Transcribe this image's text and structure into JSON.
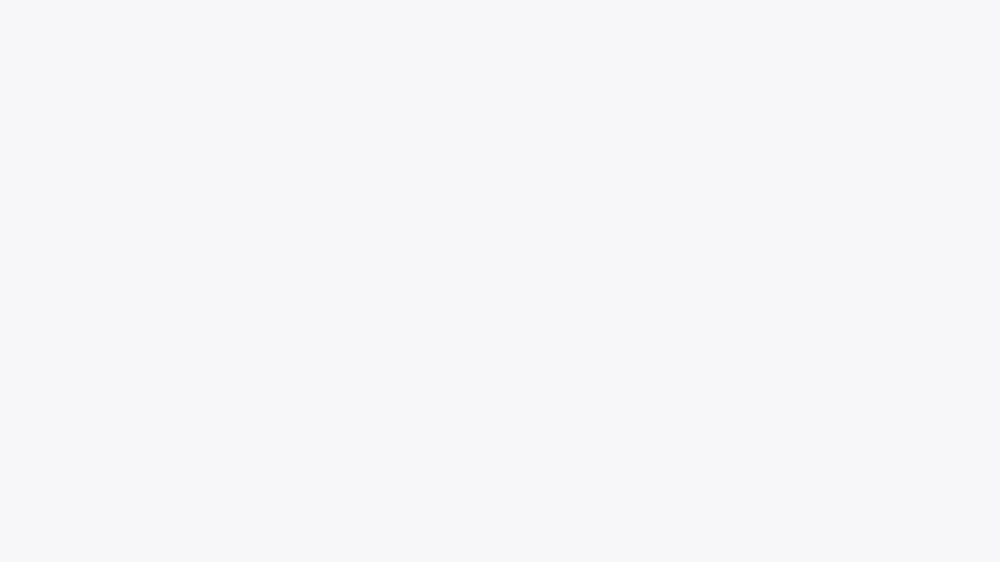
{
  "scene": {
    "description": "Isometric 3D cutaway render of a studio apartment with balcony",
    "style": "photorealistic isometric architectural visualization, no text or UI elements",
    "background": "#f7f7f9",
    "rooms": [
      "bathroom",
      "kitchen",
      "living-sleeping-area",
      "balcony"
    ]
  },
  "palette": {
    "background": "#f7f7f9",
    "shadow": "#d3d6e0",
    "slab_top": "#dde1e9",
    "slab_side": "#c9cfda",
    "floor_wood_light": "#e8caa0",
    "floor_wood_deep": "#cf9e6f",
    "plank_line": "rgba(150,100,55,0.30)",
    "deck_wood": "#cda077",
    "deck_line": "rgba(140,95,55,0.35)",
    "tile_light": "#ebe6dd",
    "wall_pink": "#f0ded6",
    "wall_white": "#f2f3f6",
    "wall_face_white": "#eef0f4",
    "wall_top": "#fafbfc",
    "wall_end": "#e8eaef",
    "wall_gray": "#c3c9d6",
    "wall_gray_light": "#dfe3eb",
    "bath_cream": "#f7e9d6",
    "bath_cream_deep": "#f1dcc1",
    "bath_floor": "#f6ecdc",
    "steel": "#aab1bd",
    "steel_light": "#cdd2db",
    "cabinet": "#efece6",
    "cabinet_line": "#d8d3c9",
    "cabinet_side": "#e2ded6",
    "counter_top": "#e8dcc8",
    "counter_speck": "#b2976f",
    "counter_face": "#bf9a64",
    "counter_face_dark": "#a4804c",
    "rattan": "#d8b386",
    "rattan_dark": "#c0965f",
    "appliance_black": "#16171a",
    "oven_white": "#f3f2f0",
    "oven_dark": "#26262a",
    "fridge_black": "#0d0e10",
    "fridge_col": "#f2f1ee",
    "fridge_col_side": "#e3e2df",
    "door_white": "#fbfbfc",
    "door_edge": "#d7dade",
    "handle_dark": "#4a4e55",
    "frame_gray": "#ccd1da",
    "wardrobe_side": "#dfe2e8",
    "wardrobe_top": "#f4f5f7",
    "shelf_wood": "#cfa163",
    "mirror_frame": "#c2996a",
    "mirror_glass": "#f0e4d4",
    "art_frame": "#c9a26b",
    "art_paper": "#faf7f2",
    "art_shape": "#d9c2a2",
    "art_shape2": "#cbb18e",
    "sconce_black": "#1d1e22",
    "headboard": "#cfa873",
    "headboard_dark": "#b08546",
    "bed_base": "#e9ebef",
    "bed_base_shade": "#d4d7de",
    "mattress": "#a7adb4",
    "mattress_dark": "#969ca3",
    "duvet": "#c6cbd1",
    "blanket": "#eceef1",
    "pillow_plaid": "#8b8272",
    "pillow_plaid2": "#7f776a",
    "pillow_gray": "#a8adb2",
    "nightstand": "#f0f1f4",
    "nightstand_side": "#dfe1e7",
    "stool": "#e8dfd3",
    "stool_shade": "#d5cabb",
    "sofa": "#ddd7c7",
    "sofa_shade": "#cbc4b2",
    "sofa_rattan": "#c9a06a",
    "table_wood": "#c69557",
    "table_wood_dark": "#a87a40",
    "side_table": "#e5dcd2",
    "pot_white": "#eff0f2",
    "pot_gray": "#c2c8d2",
    "green": "#41793a",
    "green_dark": "#2f5c2a",
    "green_light": "#5e9a4b",
    "green_bright": "#6fae57",
    "planter_white": "#edeef0",
    "planter_side": "#dcdfe4",
    "planter_cap": "#565b62",
    "pillar": "#f0ede5",
    "pillar_side": "#e2ded3",
    "glass": "rgba(196,210,222,0.30)",
    "glass_edge": "rgba(120,140,155,0.40)",
    "rail_dark": "#383d44",
    "rail_light": "#c8cdd6",
    "tv_black": "#101114",
    "desk_top": "#eceef2",
    "desk_edge": "#ccd1da",
    "metal": "#9aa1ac",
    "ledge_top": "#d8a262",
    "ledge_front": "#b07c42",
    "laptop": "#c8ccd3",
    "pebble": "#e8e9ec"
  },
  "objects": [
    "floor-slab",
    "wood-floor",
    "kitchen-tile-floor",
    "balcony-deck",
    "edge-ledge",
    "bathroom",
    "entry-wall",
    "steel-entry-door",
    "back-wall",
    "wall-art",
    "wall-spotlight",
    "oval-mirror",
    "light-switch",
    "kitchen-upper-cabinets",
    "kitchen-counter",
    "induction-cooktop",
    "coffee-maker",
    "oven",
    "refrigerator-column",
    "bathroom-door",
    "wardrobe",
    "wall-shelves",
    "vanity-desk",
    "vanity-stool",
    "bed",
    "headboard",
    "pillows",
    "nightstand",
    "flower-vase",
    "balcony-sconce",
    "balcony-planters",
    "balcony-bench",
    "sofa",
    "coffee-table",
    "side-table",
    "ficus-tree",
    "snake-plant",
    "office-chair",
    "floating-desk",
    "laptop",
    "television",
    "railing-planters",
    "pebbles",
    "glass-railing",
    "corner-pillar"
  ]
}
